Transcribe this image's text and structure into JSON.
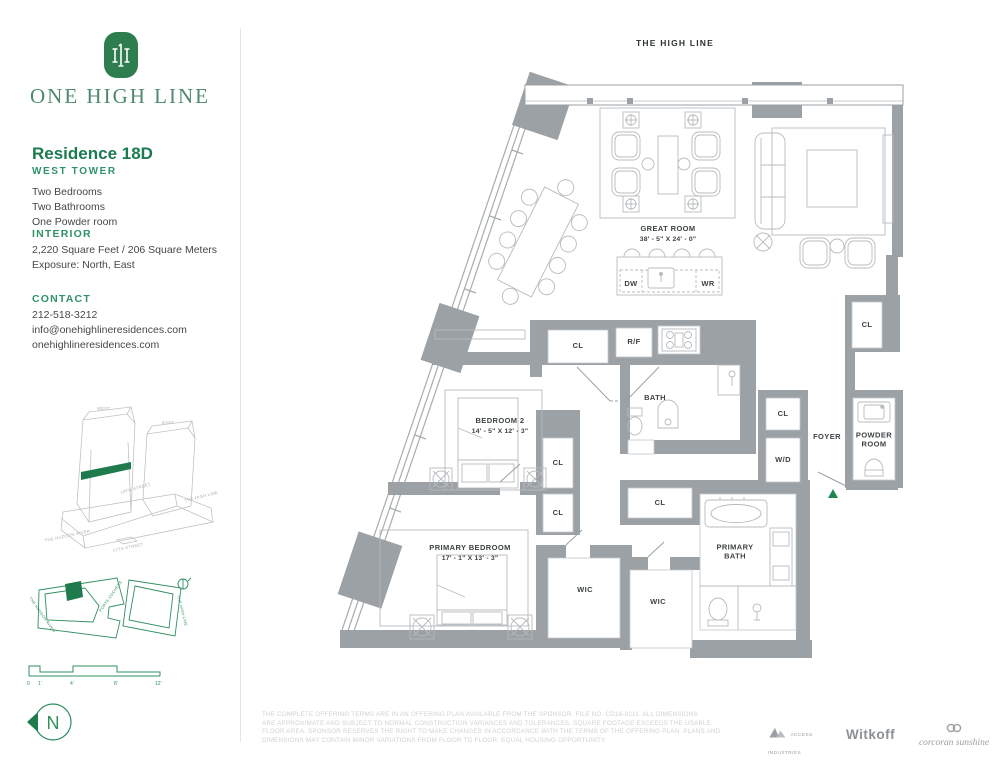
{
  "brand": {
    "name": "ONE HIGH LINE"
  },
  "residence": {
    "title": "Residence 18D",
    "tower": "WEST TOWER",
    "features": [
      "Two Bedrooms",
      "Two Bathrooms",
      "One Powder room"
    ]
  },
  "interior": {
    "heading": "INTERIOR",
    "line1": "2,220 Square Feet / 206 Square Meters",
    "line2": "Exposure: North, East"
  },
  "contact": {
    "heading": "CONTACT",
    "phone": "212-518-3212",
    "email": "info@onehighlineresidences.com",
    "website": "onehighlineresidences.com"
  },
  "building_diagram": {
    "west": "WEST",
    "east": "EAST",
    "street18": "18TH STREET",
    "highline": "THE HIGH LINE",
    "hudson": "THE HUDSON RIVER",
    "street17": "17TH STREET"
  },
  "site_map": {
    "hudson": "THE HUDSON RIVER",
    "porte": "PORTE-COCHÈRE",
    "highline": "THE HIGH LINE"
  },
  "scale_bar": {
    "ticks": [
      "0",
      "1'",
      "4'",
      "8'",
      "12'"
    ]
  },
  "compass": {
    "label": "N"
  },
  "plan": {
    "header": "THE HIGH LINE",
    "rooms": {
      "great_room": "GREAT ROOM",
      "great_room_dims": "38' - 5\" X 24' - 0\"",
      "bedroom2": "BEDROOM 2",
      "bedroom2_dims": "14' - 5\" X 12' - 3\"",
      "primary_bedroom": "PRIMARY BEDROOM",
      "primary_bedroom_dims": "17' - 1\" X 13' - 3\"",
      "bath": "BATH",
      "primary_bath": "PRIMARY BATH",
      "powder": "POWDER ROOM",
      "foyer": "FOYER",
      "wic": "WIC",
      "cl": "CL",
      "rf": "R/F",
      "wd": "W/D",
      "dw": "DW",
      "wr": "WR"
    }
  },
  "footer": {
    "disclaimer_lines": [
      "THE COMPLETE OFFERING TERMS ARE IN AN OFFERING PLAN AVAILABLE FROM THE SPONSOR. FILE NO. CD16-0211. ALL DIMENSIONS",
      "ARE APPROXIMATE AND SUBJECT TO NORMAL CONSTRUCTION VARIANCES AND TOLERANCES. SQUARE FOOTAGE EXCEEDS THE USABLE",
      "FLOOR AREA. SPONSOR RESERVES THE RIGHT TO MAKE CHANGES IN ACCORDANCE WITH THE TERMS OF THE OFFERING PLAN. PLANS AND",
      "DIMENSIONS MAY CONTAIN MINOR VARIATIONS FROM FLOOR TO FLOOR. EQUAL HOUSING OPPORTUNITY"
    ],
    "logos": {
      "access": "ACCESS INDUSTRIES",
      "witkoff": "Witkoff",
      "corcoran": "corcoran sunshine"
    }
  }
}
